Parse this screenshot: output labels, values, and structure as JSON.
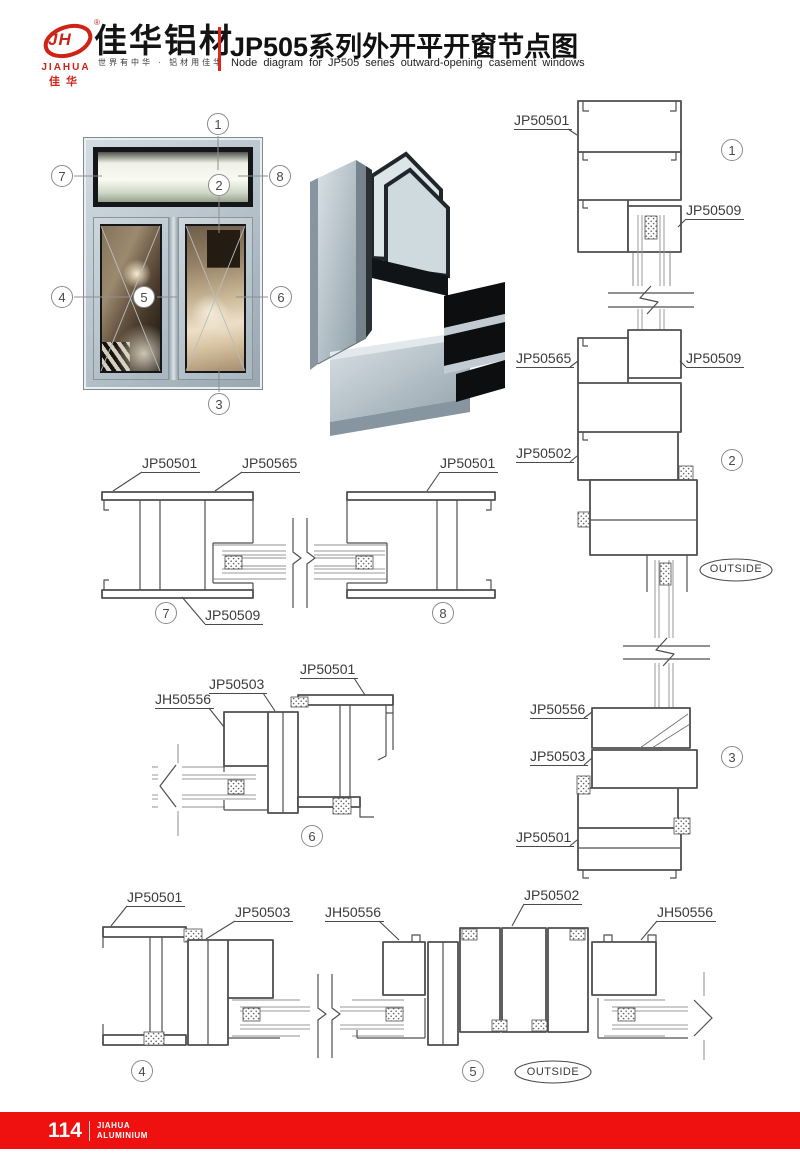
{
  "header": {
    "logo_monogram": "JH",
    "logo_reg": "®",
    "logo_en": "JIAHUA",
    "logo_cn": "佳华",
    "company": "佳华铝材",
    "slogan": "世界有中华 · 铝材用佳华",
    "title": "JP505系列外开平开窗节点图",
    "subtitle": "Node diagram for JP505 series outward-opening casement windows"
  },
  "colors": {
    "brand_red": "#cf2318",
    "footer_red": "#ef1010",
    "drawing_line": "#4f4f4f"
  },
  "photo_callouts": {
    "c1": "1",
    "c2": "2",
    "c3": "3",
    "c4": "4",
    "c5": "5",
    "c6": "6",
    "c7": "7",
    "c8": "8"
  },
  "right_strip": {
    "label_top_frame": "JP50501",
    "callout_1": "1",
    "label_top_sash": "JP50509",
    "label_mid_frame": "JP50565",
    "label_mid_sash": "JP50509",
    "label_mullion": "JP50502",
    "callout_2": "2",
    "outside": "OUTSIDE",
    "label_bottom_sash": "JP50556",
    "callout_3": "3",
    "label_bottom_transom": "JP50503",
    "label_bottom_frame": "JP50501"
  },
  "mid_strip": {
    "label_left_frame": "JP50501",
    "label_center_mullion": "JP50565",
    "label_right_frame": "JP50501",
    "callout_7": "7",
    "label_sash": "JP50509",
    "callout_8": "8"
  },
  "detail6": {
    "label_frame": "JP50501",
    "label_transom": "JP50503",
    "label_sash": "JH50556",
    "callout_6": "6"
  },
  "bottom_strip": {
    "label_left_frame": "JP50501",
    "label_left_transom": "JP50503",
    "label_left_sash": "JH50556",
    "label_mullion": "JP50502",
    "label_right_sash": "JH50556",
    "callout_4": "4",
    "callout_5": "5",
    "outside": "OUTSIDE"
  },
  "footer": {
    "page": "114",
    "brand_line1": "JIAHUA",
    "brand_line2": "ALUMINIUM"
  }
}
